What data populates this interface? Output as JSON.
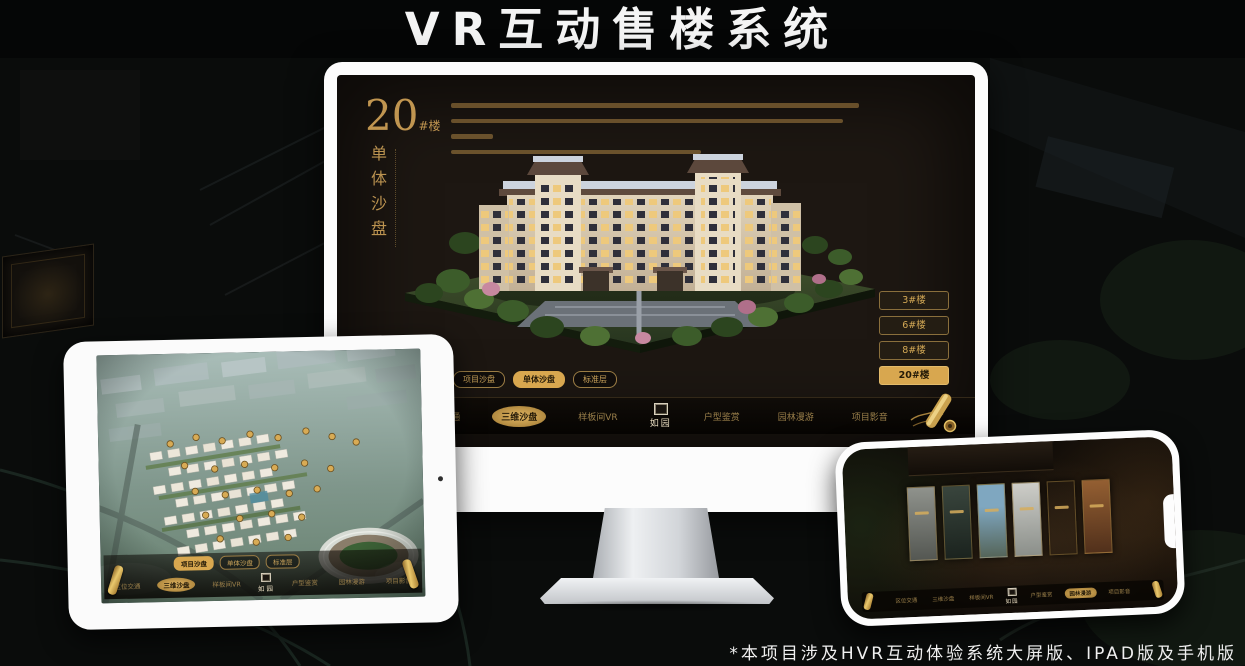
{
  "title": "VR互动售楼系统",
  "footnote": "*本项目涉及HVR互动体验系统大屏版、IPAD版及手机版",
  "colors": {
    "gold": "#c9a25c",
    "gold_active": "#d8a74f",
    "screen_bg": "#1d1712",
    "title_color": "#f4f4f4"
  },
  "app": {
    "logo": "如园",
    "tabs": [
      "项目沙盘",
      "单体沙盘",
      "标准层"
    ],
    "menu": [
      {
        "label": "区位交通"
      },
      {
        "label": "三维沙盘"
      },
      {
        "label": "样板间VR"
      },
      {
        "label": "户型鉴赏"
      },
      {
        "label": "园林漫游"
      },
      {
        "label": "项目影音"
      }
    ]
  },
  "monitor": {
    "heading_number": "20",
    "heading_suffix": "#楼",
    "heading_vertical": "单体沙盘",
    "active_tab": "单体沙盘",
    "active_menu": "三维沙盘",
    "floor_buttons": [
      {
        "label": "3#楼",
        "active": false
      },
      {
        "label": "6#楼",
        "active": false
      },
      {
        "label": "8#楼",
        "active": false
      },
      {
        "label": "20#楼",
        "active": true
      }
    ]
  },
  "tablet": {
    "active_tab": "项目沙盘",
    "active_menu": "三维沙盘"
  },
  "phone": {
    "active_menu": "园林漫游"
  }
}
